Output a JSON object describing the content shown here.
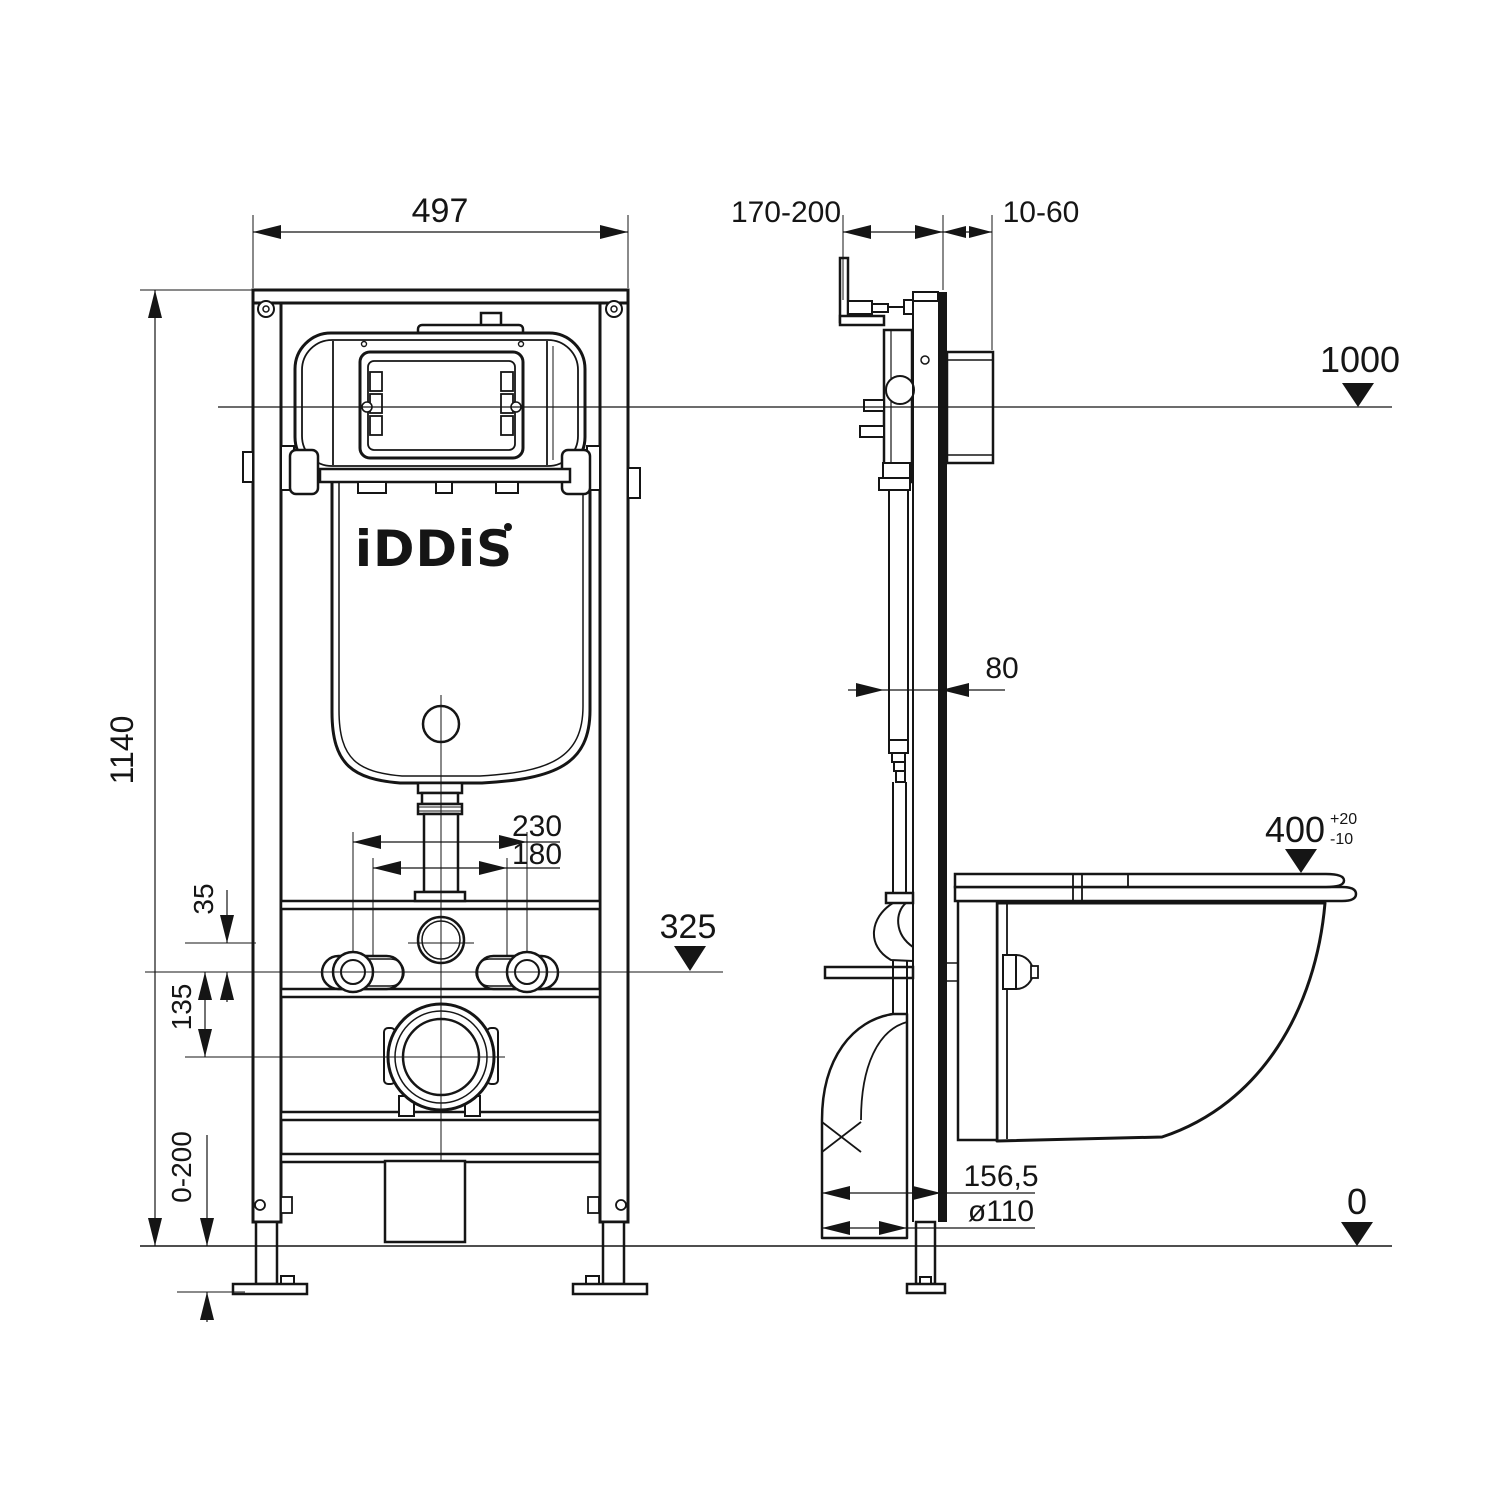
{
  "title": "IDDIS wall-hung toilet installation frame — dimensional drawing",
  "brand": {
    "logo": "iDDiS"
  },
  "dims": {
    "frame_width": "497",
    "frame_height": "1140",
    "level_top": "1000",
    "level_floor": "0",
    "install_depth": "170-200",
    "finish_gap": "10-60",
    "profile_depth": "80",
    "stud_spacing_wide": "230",
    "stud_spacing_narrow": "180",
    "water_offset": "35",
    "drain_offset": "135",
    "stud_level": "325",
    "bowl_height": "400",
    "bowl_tol_plus": "+20",
    "bowl_tol_minus": "-10",
    "leg_adjust_range": "0-200",
    "drain_setback": "156,5",
    "drain_diameter": "ø110"
  }
}
